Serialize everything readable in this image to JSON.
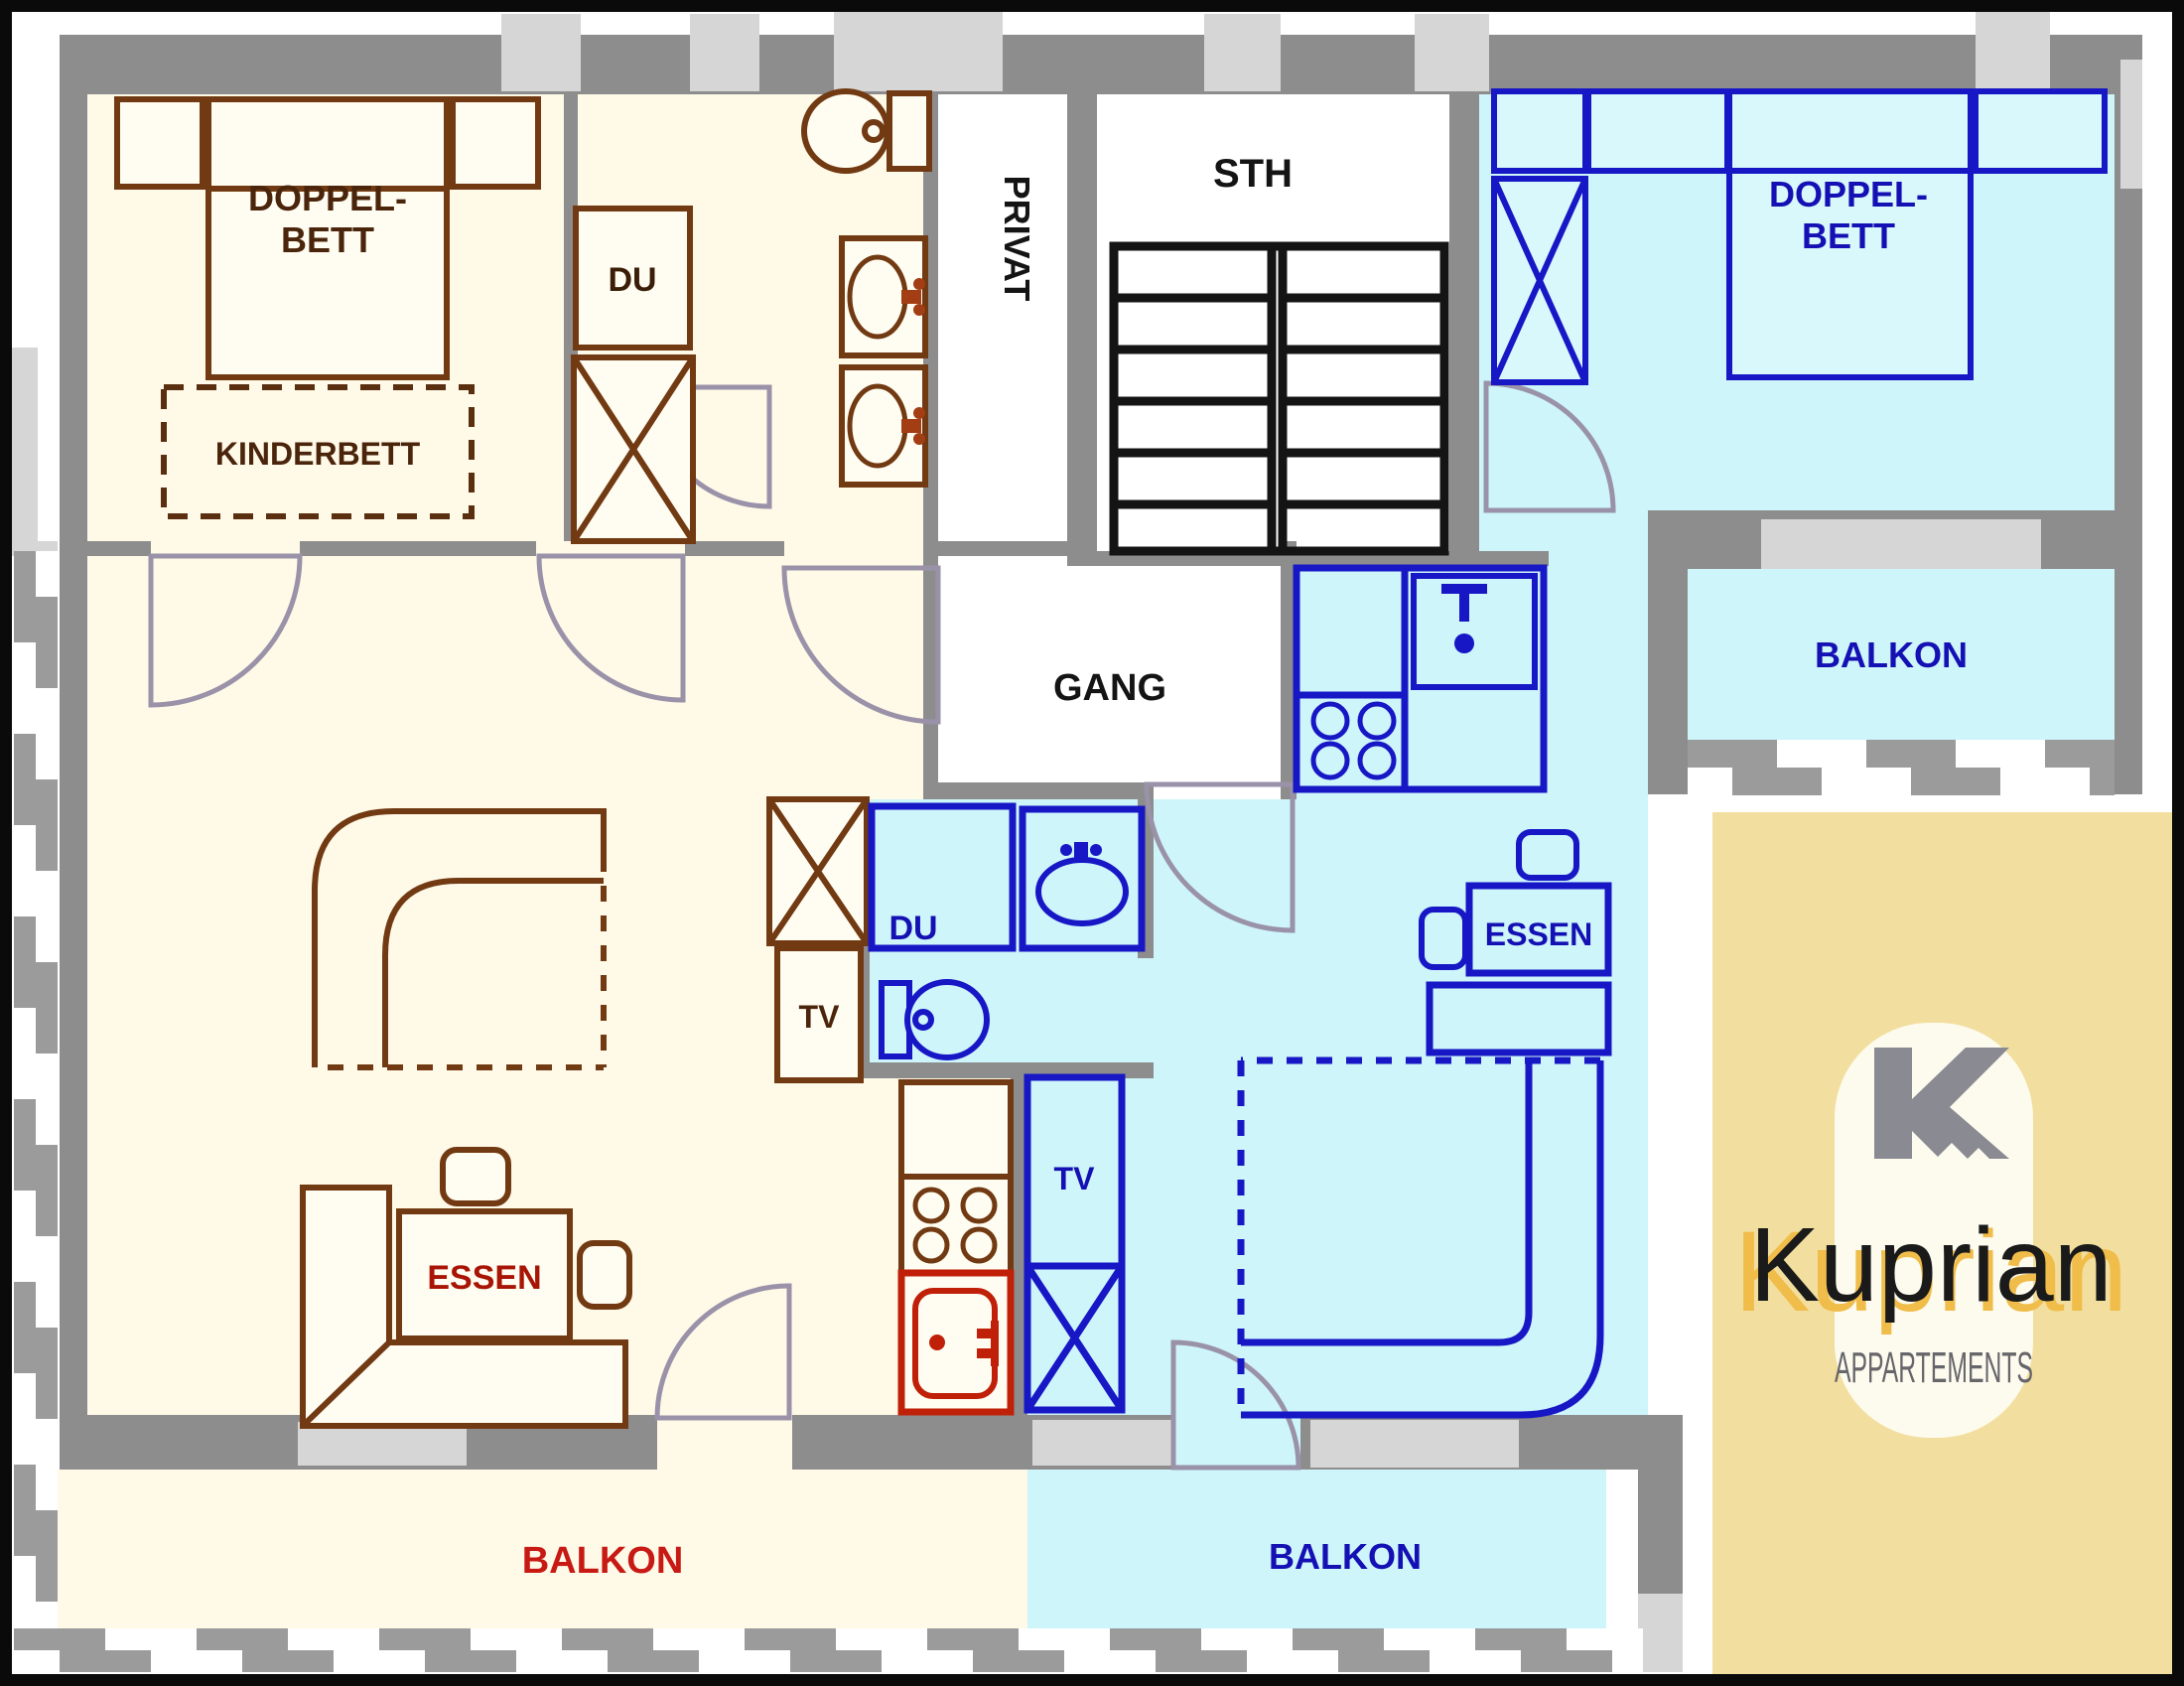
{
  "plan": {
    "apartment_left": {
      "bedroom": {
        "bed_line1": "DOPPEL-",
        "bed_line2": "BETT",
        "crib": "KINDERBETT"
      },
      "bath": {
        "shower": "DU"
      },
      "living": {
        "tv": "TV",
        "dining": "ESSEN"
      },
      "balcony": "BALKON"
    },
    "apartment_right": {
      "bedroom": {
        "bed_line1": "DOPPEL-",
        "bed_line2": "BETT"
      },
      "bath": {
        "shower": "DU"
      },
      "living": {
        "tv": "TV",
        "dining": "ESSEN"
      },
      "balcony_top": "BALKON",
      "balcony_bottom": "BALKON"
    },
    "shared": {
      "stairwell": "STH",
      "corridor": "GANG",
      "private": "PRIVAT"
    }
  },
  "logo": {
    "monogram": "K",
    "brand": "Kuprian",
    "subtitle": "APPARTEMENTS"
  },
  "colors": {
    "wall": "#8D8D8D",
    "window": "#D6D6D6",
    "apartment_left_floor": "#FFF9E8",
    "apartment_left_line": "#713A12",
    "apartment_left_text": "#4A250B",
    "apartment_left_accent_red": "#C02008",
    "apartment_right_floor": "#CDF5FA",
    "apartment_right_line": "#1717C6",
    "apartment_right_text": "#1410B4",
    "balkon_left_text": "#C81A14",
    "door_arc": "#9A92A8",
    "stairs": "#141414",
    "logo_bg": "#F2DF9F",
    "logo_pill": "#FDFBEE",
    "logo_mark": "#8A8A92",
    "logo_text": "#1A1A1A",
    "logo_shadow": "#F0BC4A",
    "logo_subtitle": "#66666B"
  }
}
